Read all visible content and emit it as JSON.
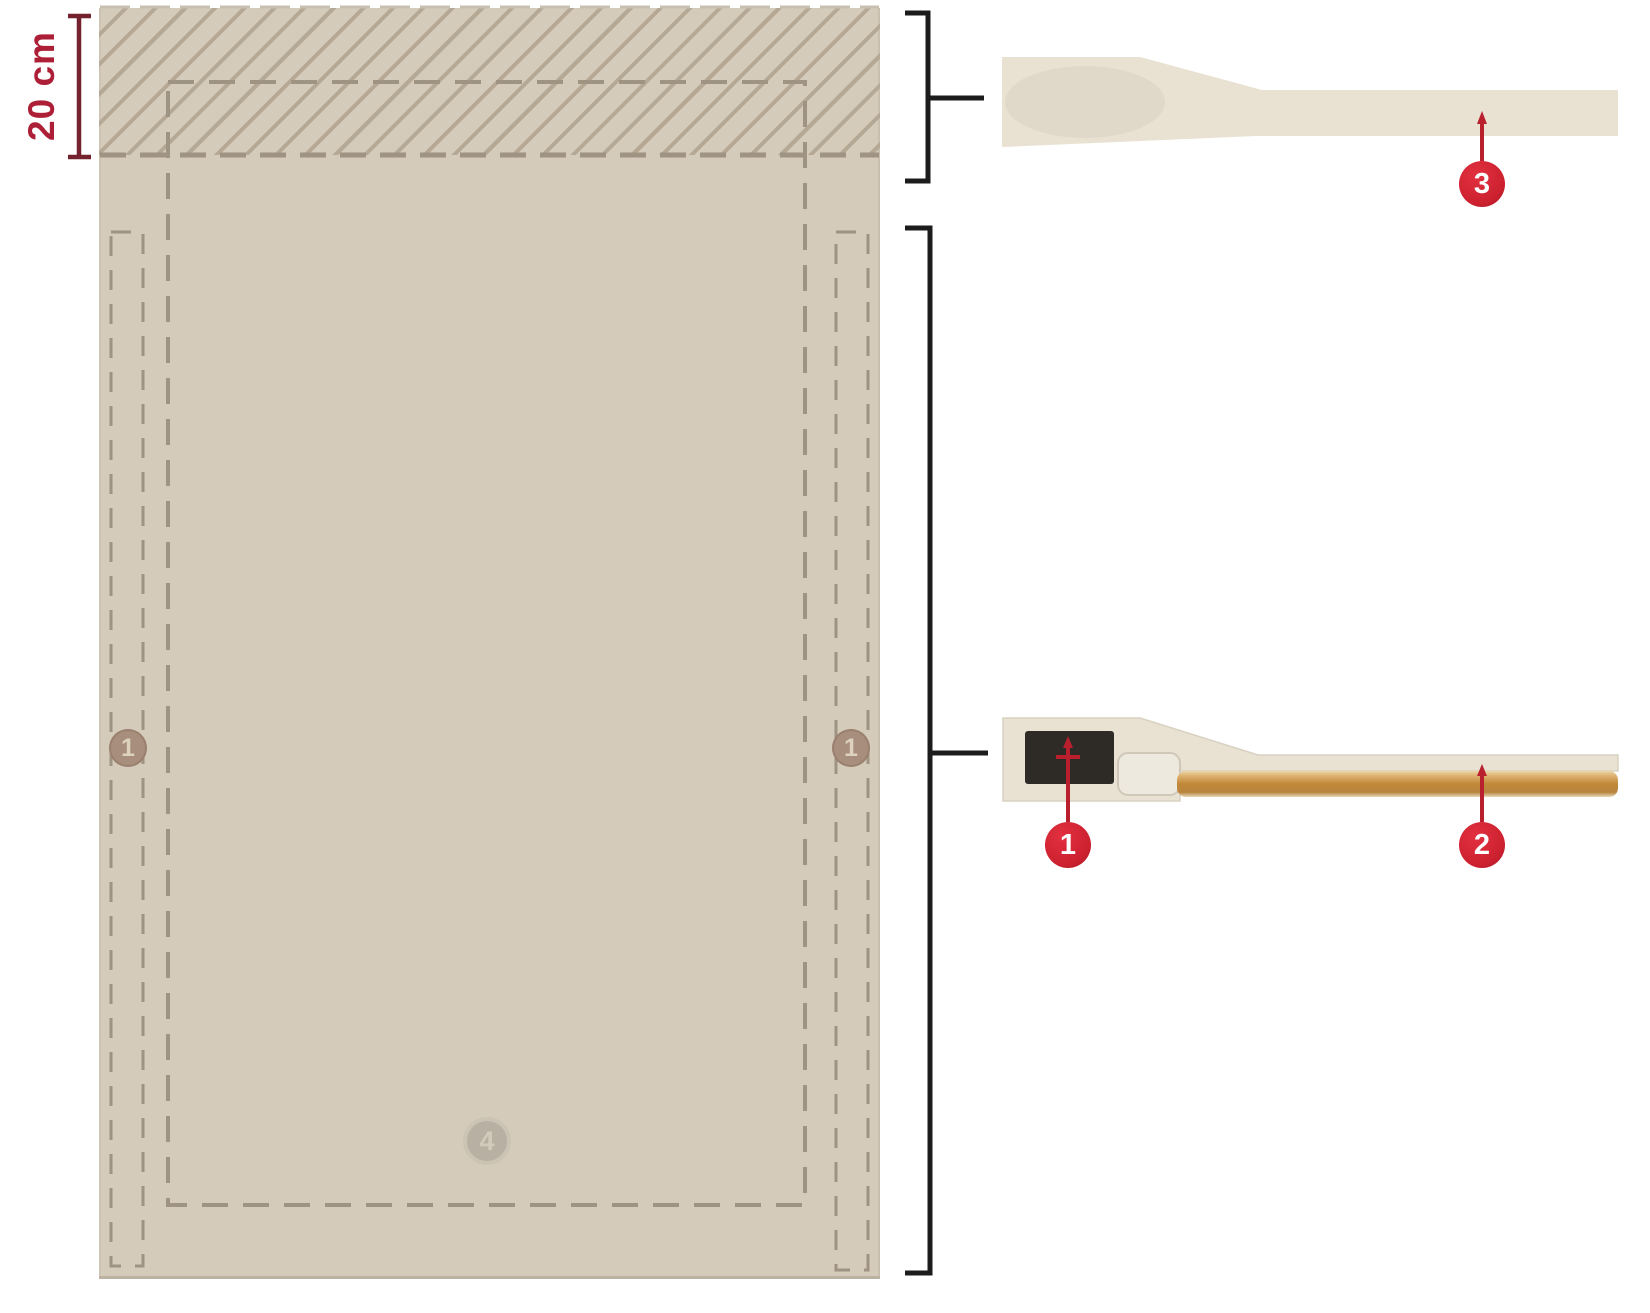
{
  "plan_view": {
    "dimension": "20 cm",
    "edge_marker_left": "1",
    "edge_marker_right": "1",
    "bottom_marker": "4"
  },
  "cross_sections": {
    "callout_sensor": "1",
    "callout_tube": "2",
    "callout_top_band": "3"
  },
  "theme": {
    "page_bg": "#ffffff",
    "pad_fill": "#d4cbba",
    "pad_edge": "#bdb2a1",
    "hatch_line": "#b5a894",
    "dash_line": "#9f9381",
    "dim_text_red": "#ad1f36",
    "dim_line_red": "#73222e",
    "badge_red": "#cd2130",
    "badge_text": "#ffffff",
    "plan_marker_tan": "#a78e7d",
    "plan_marker_gray": "#b6aea0",
    "plan_marker_text": "#ddd2bd",
    "bracket_black": "#1c1c1c",
    "section_fill": "#e9e2d3",
    "section_shade": "#d8d0c0",
    "chip_dark": "#2e2b27",
    "tube_light": "#ecd6a8",
    "tube_mid": "#c18838",
    "tube_dark": "#b8853f",
    "callout_line_red": "#b91f2d"
  }
}
